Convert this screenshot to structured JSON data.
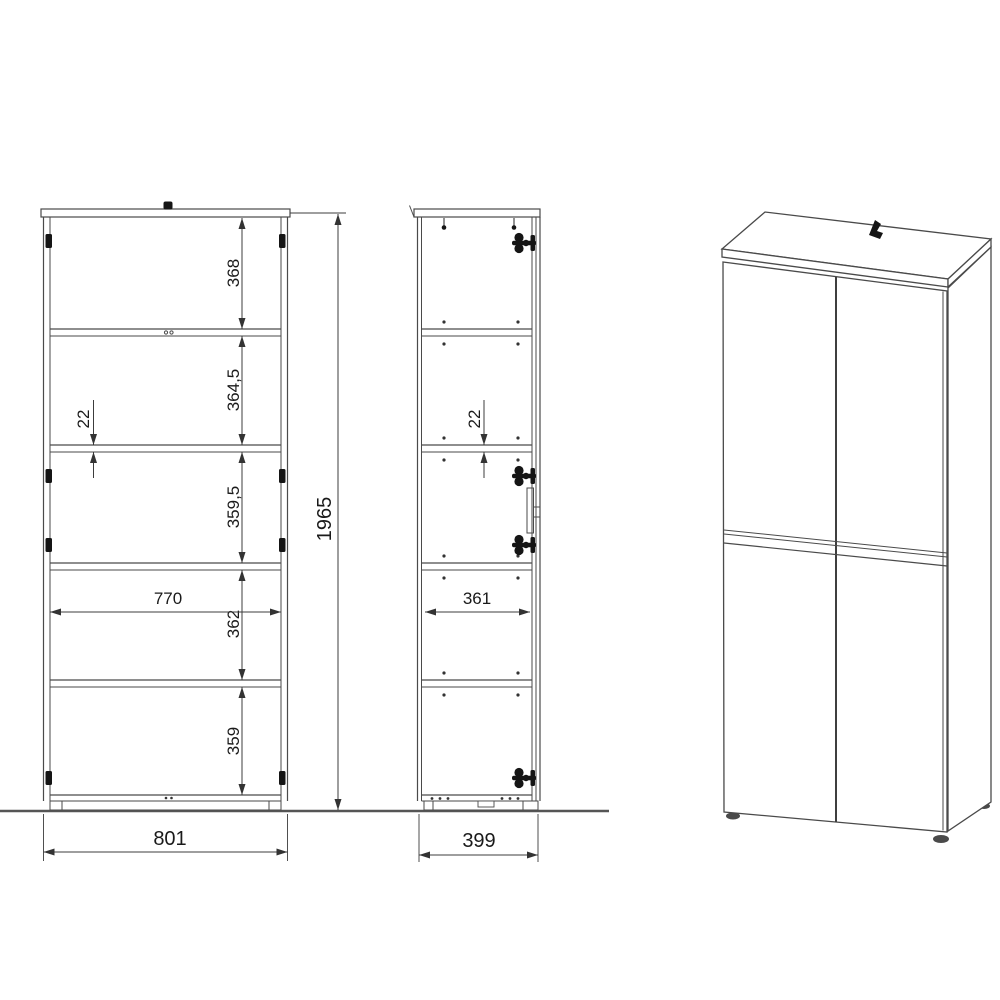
{
  "dimensions": {
    "front": {
      "section_top": "368",
      "section_upper": "364,5",
      "shelf_thickness": "22",
      "section_middle": "359,5",
      "inner_width": "770",
      "section_lower": "362",
      "section_bottom": "359",
      "outer_width": "801",
      "total_height": "1965"
    },
    "side": {
      "shelf_thickness": "22",
      "inner_depth": "361",
      "outer_depth": "399"
    }
  },
  "colors": {
    "line": "#4a4a4a",
    "text": "#1a1a1a",
    "hardware": "#151515",
    "ground": "#555555",
    "background": "#ffffff"
  }
}
